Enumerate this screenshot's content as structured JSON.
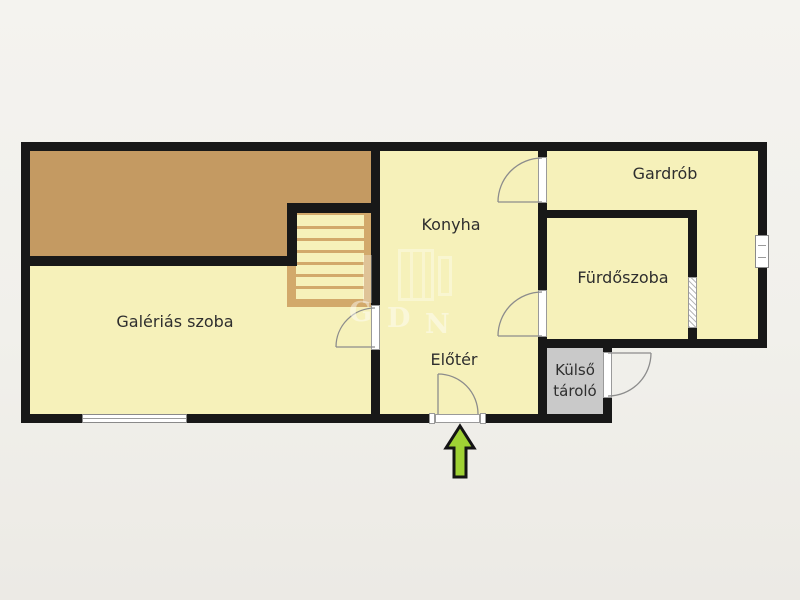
{
  "plan": {
    "type": "floor-plan",
    "rooms": [
      {
        "id": "galerias",
        "label": "Galériás szoba"
      },
      {
        "id": "konyha",
        "label": "Konyha"
      },
      {
        "id": "gardrob",
        "label": "Gardrób"
      },
      {
        "id": "furdoszoba",
        "label": "Fürdőszoba"
      },
      {
        "id": "eloter",
        "label": "Előtér"
      },
      {
        "id": "kulso_tarolo",
        "label_line1": "Külső",
        "label_line2": "tároló"
      }
    ],
    "features": [
      "gallery-loft-area",
      "staircase",
      "entrance-door",
      "exterior-storage-door",
      "interior-doors",
      "sliding-door-bathroom",
      "window-south",
      "window-east"
    ],
    "watermark": {
      "letter_g": "G",
      "letter_d": "D",
      "letter_n": "N"
    },
    "colors": {
      "room_fill": "#f6f1ba",
      "gallery_fill": "#c49a62",
      "stairs_fill": "#d2a96b",
      "wall": "#181818",
      "storage_fill": "#c9c9c9",
      "background": "#f1f0eb",
      "entrance_arrow": "#9fd134",
      "door_arc": "#8c8c8c",
      "label_text": "#2e2e2e"
    }
  }
}
